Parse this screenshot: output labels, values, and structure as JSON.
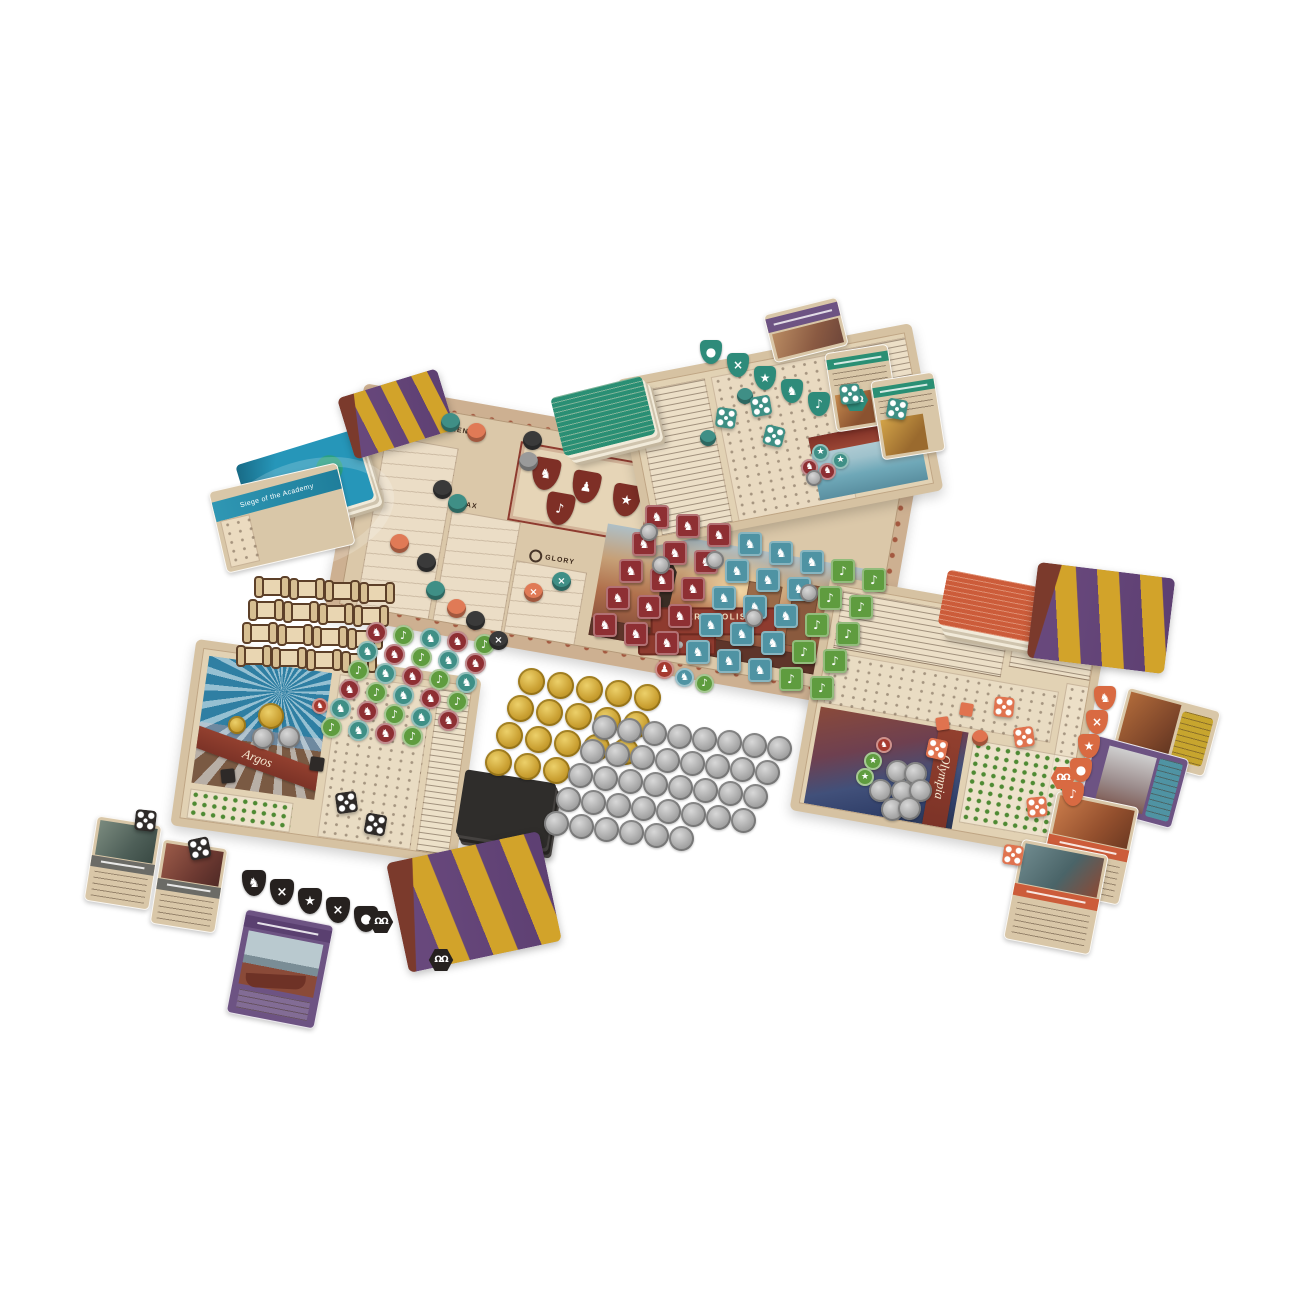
{
  "board": {
    "citizens_label": "CITIZENS",
    "tax_label": "TAX",
    "glory_label": "GLORY",
    "troops_label": "TROOPS",
    "troops_icon": "×",
    "glory_icon": "( )",
    "shield_glyphs": [
      "♞",
      "♟",
      "★",
      "♪",
      "×"
    ],
    "persepolis": {
      "name": "PERSEPOLIS",
      "cost_multiplier": "×15",
      "coin_value": "15"
    }
  },
  "player_boards": {
    "left_name": "Argos",
    "right_name": "Olympia"
  },
  "cards": {
    "event_title": "Siege of the Academy"
  },
  "icons": {
    "citizens": "person",
    "tax": "amphora",
    "glory": "laurel-wreath",
    "troops": "crossed-swords",
    "hex_token": "double-omega"
  },
  "tokens": {
    "hex_glyph": "ΩΩ"
  },
  "palette": {
    "board_tan": "#dbc8a9",
    "frame_rust": "#9c4a32",
    "banner_maroon": "#8e3b2f",
    "red_token": "#8e2f33",
    "teal_token": "#3f8f86",
    "blue_tile": "#4f93a3",
    "green_token": "#5f9c3f",
    "orange_piece": "#e0734f",
    "black_piece": "#2e2a28",
    "gold_coin": "#caa032",
    "silver_coin": "#a8a8a8",
    "card_purple": "#6d5383",
    "card_green": "#2a8f74",
    "card_blue": "#2696b9",
    "card_orange": "#cc5c3a",
    "card_yellow": "#c7a52e",
    "drape_purple": "#6a4a7e",
    "drape_yellow": "#d2a32a",
    "drape_maroon": "#7b3a2c"
  },
  "clusters": [
    {
      "name": "scroll-tokens",
      "type": "scroll",
      "x": 258,
      "y": 578,
      "cols": 4,
      "count": 16,
      "dx": 35,
      "dy": 2,
      "rx": -6,
      "ry": 23,
      "w": 28,
      "h": 18,
      "colors": [
        "#e9d6b2"
      ]
    },
    {
      "name": "knowledge-tokens",
      "type": "disc",
      "x": 366,
      "y": 622,
      "cols": 5,
      "count": 29,
      "dx": 27,
      "dy": 3,
      "rx": -9,
      "ry": 19,
      "w": 21,
      "h": 21,
      "colors": [
        "#8e2f33",
        "#5f9c3f",
        "#3f8f86"
      ],
      "glyphs": [
        "♞",
        "♪",
        "♞"
      ]
    },
    {
      "name": "achievement-tiles",
      "type": "tile",
      "x": 645,
      "y": 505,
      "cols": 8,
      "count": 40,
      "dx": 31,
      "dy": 9,
      "rx": -13,
      "ry": 27,
      "w": 24,
      "h": 24,
      "colorMode": "col",
      "colors": [
        "#8e2f33",
        "#8e2f33",
        "#8e2f33",
        "#4f93a3",
        "#4f93a3",
        "#4f93a3",
        "#5f9c3f",
        "#5f9c3f"
      ],
      "glyphs": [
        "♞",
        "♞",
        "♞",
        "♞",
        "♞",
        "♞",
        "♪",
        "♪"
      ]
    },
    {
      "name": "board-silver-coins",
      "type": "coin-silver",
      "points": [
        [
          640,
          523
        ],
        [
          652,
          556
        ],
        [
          706,
          551
        ],
        [
          800,
          584
        ],
        [
          745,
          609
        ]
      ],
      "w": 18,
      "h": 18
    },
    {
      "name": "gold-coins",
      "type": "coin-gold",
      "x": 518,
      "y": 668,
      "cols": 5,
      "count": 18,
      "dx": 29,
      "dy": 4,
      "rx": -11,
      "ry": 27,
      "w": 27,
      "h": 27
    },
    {
      "name": "silver-coins",
      "type": "coin-silver",
      "x": 592,
      "y": 715,
      "cols": 8,
      "count": 38,
      "dx": 25,
      "dy": 3,
      "rx": -12,
      "ry": 24,
      "w": 25,
      "h": 25
    },
    {
      "name": "black-shield-tokens",
      "type": "shield",
      "x": 242,
      "y": 870,
      "cols": 5,
      "count": 5,
      "dx": 28,
      "dy": 9,
      "w": 24,
      "h": 26,
      "colors": [
        "#26211f"
      ],
      "glyphs": [
        "♞",
        "×",
        "★",
        "×",
        "●"
      ]
    },
    {
      "name": "teal-shield-tokens",
      "type": "shield",
      "x": 700,
      "y": 340,
      "cols": 5,
      "count": 5,
      "dx": 27,
      "dy": 13,
      "w": 22,
      "h": 24,
      "colors": [
        "#2e8b7a"
      ],
      "glyphs": [
        "●",
        "×",
        "★",
        "♞",
        "♪"
      ]
    },
    {
      "name": "orange-shield-tokens",
      "type": "shield",
      "x": 1094,
      "y": 686,
      "cols": 1,
      "count": 5,
      "rx": -8,
      "ry": 24,
      "w": 22,
      "h": 24,
      "colors": [
        "#d96a42"
      ],
      "glyphs": [
        "♞",
        "×",
        "★",
        "●",
        "♪"
      ]
    },
    {
      "name": "omega-hex-tokens",
      "type": "hex",
      "points": [
        [
          843,
          388
        ],
        [
          368,
          910
        ],
        [
          428,
          948
        ],
        [
          1050,
          766
        ]
      ],
      "w": 26,
      "h": 24,
      "colors": [
        "#2e8b7a",
        "#26211f",
        "#26211f",
        "#d96a42"
      ],
      "glyphText": "ΩΩ",
      "fs": 9
    },
    {
      "name": "main-board-pawns",
      "type": "pawn",
      "points": [
        [
          441,
          413
        ],
        [
          467,
          423
        ],
        [
          523,
          431
        ],
        [
          433,
          480
        ],
        [
          448,
          494
        ],
        [
          390,
          534
        ],
        [
          417,
          553
        ],
        [
          426,
          581
        ],
        [
          447,
          599
        ],
        [
          466,
          611
        ],
        [
          552,
          572
        ],
        [
          524,
          583
        ],
        [
          489,
          631
        ],
        [
          519,
          452
        ]
      ],
      "w": 19,
      "h": 19,
      "colors": [
        "#3f8f86",
        "#e07a56",
        "#3a3a3a",
        "#3a3a3a",
        "#3f8f86",
        "#e07a56",
        "#3a3a3a",
        "#3f8f86",
        "#e07a56",
        "#3a3a3a",
        "#3f8f86",
        "#e07a56",
        "#3a3a3a",
        "#9a9a9a"
      ],
      "glyphs": [
        "",
        "",
        "",
        "",
        "",
        "",
        "",
        "",
        "",
        "",
        "×",
        "×",
        "×",
        ""
      ]
    },
    {
      "name": "top-board-pawns",
      "type": "pawn",
      "points": [
        [
          700,
          430
        ],
        [
          737,
          388
        ]
      ],
      "w": 16,
      "h": 16,
      "colors": [
        "#3f8f86"
      ]
    },
    {
      "name": "top-board-discs",
      "type": "disc",
      "points": [
        [
          812,
          444
        ],
        [
          832,
          452
        ],
        [
          801,
          459
        ],
        [
          819,
          463
        ]
      ],
      "w": 17,
      "h": 17,
      "colors": [
        "#3f8f86",
        "#3f8f86",
        "#8e2f33",
        "#8e2f33"
      ],
      "glyphs": [
        "★",
        "★",
        "♞",
        "♞"
      ]
    },
    {
      "name": "top-board-coin",
      "type": "coin-silver",
      "points": [
        [
          806,
          470
        ]
      ],
      "w": 16,
      "h": 16
    },
    {
      "name": "olympia-coin-pile",
      "type": "coin-silver",
      "points": [
        [
          886,
          760
        ],
        [
          904,
          762
        ],
        [
          869,
          779
        ],
        [
          891,
          780
        ],
        [
          909,
          779
        ],
        [
          881,
          798
        ],
        [
          898,
          797
        ]
      ],
      "w": 23,
      "h": 23
    },
    {
      "name": "olympia-discs",
      "type": "disc",
      "points": [
        [
          864,
          752
        ],
        [
          856,
          768
        ]
      ],
      "w": 18,
      "h": 18,
      "colors": [
        "#5f9c3f"
      ],
      "glyphs": [
        "★"
      ]
    },
    {
      "name": "olympia-badge",
      "type": "disc",
      "points": [
        [
          876,
          737
        ]
      ],
      "w": 16,
      "h": 16,
      "colors": [
        "#a53a30"
      ],
      "glyphs": [
        "♞"
      ]
    },
    {
      "name": "argos-gold-coin",
      "type": "coin-gold",
      "points": [
        [
          258,
          703
        ]
      ],
      "w": 26,
      "h": 26
    },
    {
      "name": "argos-gold-coin-small",
      "type": "coin-gold",
      "points": [
        [
          228,
          716
        ]
      ],
      "w": 18,
      "h": 18
    },
    {
      "name": "argos-silver-coins",
      "type": "coin-silver",
      "points": [
        [
          252,
          727
        ],
        [
          278,
          726
        ]
      ],
      "w": 22,
      "h": 22
    },
    {
      "name": "argos-badge",
      "type": "disc",
      "points": [
        [
          312,
          698
        ]
      ],
      "w": 16,
      "h": 16,
      "colors": [
        "#a53a30"
      ],
      "glyphs": [
        "♞"
      ]
    },
    {
      "name": "teal-dice",
      "type": "die",
      "points": [
        [
          716,
          408
        ],
        [
          751,
          396
        ],
        [
          764,
          426
        ],
        [
          840,
          384
        ],
        [
          887,
          399
        ]
      ],
      "w": 20,
      "h": 20,
      "colors": [
        "#3d8f84"
      ],
      "rotates": [
        8,
        -10,
        14,
        -6,
        10
      ]
    },
    {
      "name": "black-dice",
      "type": "die",
      "points": [
        [
          336,
          792
        ],
        [
          365,
          814
        ],
        [
          135,
          810
        ],
        [
          189,
          838
        ]
      ],
      "w": 21,
      "h": 21,
      "colors": [
        "#2e2a28"
      ],
      "rotates": [
        -8,
        10,
        6,
        -12
      ]
    },
    {
      "name": "black-cubes",
      "type": "cube",
      "points": [
        [
          310,
          757
        ],
        [
          221,
          769
        ]
      ],
      "w": 14,
      "h": 14,
      "colors": [
        "#2e2a28"
      ],
      "rotates": [
        8,
        -6
      ]
    },
    {
      "name": "orange-dice",
      "type": "die",
      "points": [
        [
          994,
          697
        ],
        [
          1014,
          727
        ],
        [
          927,
          739
        ],
        [
          1027,
          797
        ],
        [
          1003,
          845
        ]
      ],
      "w": 20,
      "h": 20,
      "colors": [
        "#e0734f"
      ],
      "rotates": [
        6,
        -8,
        12,
        -6,
        8
      ]
    },
    {
      "name": "orange-cubes",
      "type": "cube",
      "points": [
        [
          960,
          703
        ],
        [
          936,
          717
        ]
      ],
      "w": 13,
      "h": 13,
      "colors": [
        "#e0734f"
      ],
      "rotates": [
        10,
        -8
      ]
    },
    {
      "name": "orange-pawn",
      "type": "pawn",
      "points": [
        [
          972,
          730
        ]
      ],
      "w": 16,
      "h": 16,
      "colors": [
        "#e0734f"
      ]
    },
    {
      "name": "persepolis-plate-discs",
      "type": "disc",
      "points": [
        [
          655,
          660
        ],
        [
          675,
          668
        ],
        [
          695,
          674
        ]
      ],
      "w": 19,
      "h": 19,
      "colors": [
        "#a53a30",
        "#4f93a3",
        "#5f9c3f"
      ],
      "glyphs": [
        "♟",
        "♞",
        "♪"
      ]
    }
  ]
}
